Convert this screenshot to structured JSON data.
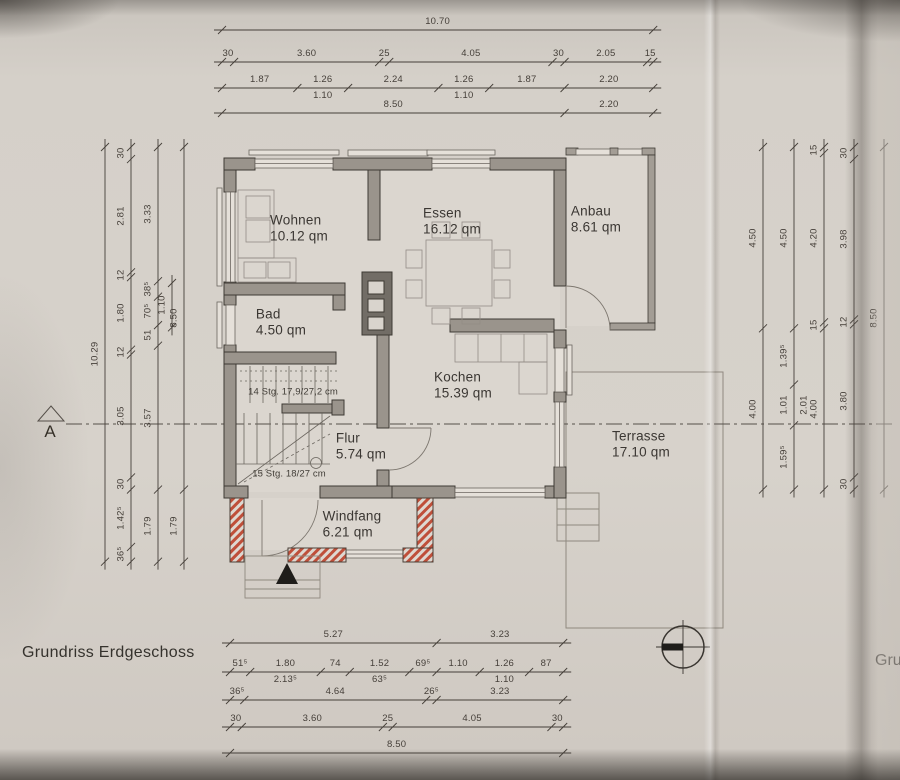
{
  "page": {
    "title": "Grundriss Erdgeschoss",
    "adjacent_page_text": "Gru"
  },
  "section": {
    "label": "A"
  },
  "rooms": {
    "wohnen": {
      "name": "Wohnen",
      "area": "10.12 qm"
    },
    "essen": {
      "name": "Essen",
      "area": "16.12 qm"
    },
    "anbau": {
      "name": "Anbau",
      "area": "8.61 qm"
    },
    "bad": {
      "name": "Bad",
      "area": "4.50 qm"
    },
    "kochen": {
      "name": "Kochen",
      "area": "15.39 qm"
    },
    "flur": {
      "name": "Flur",
      "area": "5.74 qm"
    },
    "windfang": {
      "name": "Windfang",
      "area": "6.21 qm"
    },
    "terrasse": {
      "name": "Terrasse",
      "area": "17.10 qm"
    }
  },
  "stairs": {
    "upper_label": "14 Stg. 17,9/27,2 cm",
    "lower_label": "15 Stg. 18/27 cm"
  },
  "colors": {
    "paper": "#d6d1ca",
    "wall_fill": "#9a948c",
    "wall_stroke": "#3e3a34",
    "thin_line": "#8b857d",
    "dimension": "#453f39",
    "new_wall_hatch": "#bf4f3a",
    "black": "#1f1d1a"
  },
  "dimensions": {
    "scale_px_per_m": 40.3,
    "chains": [
      {
        "id": "top-overall",
        "axis": "h",
        "line": 30,
        "start": 222,
        "scale": 40.3,
        "segments": [
          {
            "label": "10.70",
            "m": 10.7
          }
        ]
      },
      {
        "id": "top-outer",
        "axis": "h",
        "line": 62,
        "start": 222,
        "scale": 40.3,
        "segments": [
          {
            "label": "30",
            "m": 0.3
          },
          {
            "label": "3.60",
            "m": 3.6
          },
          {
            "label": "25",
            "m": 0.25
          },
          {
            "label": "4.05",
            "m": 4.05
          },
          {
            "label": "30",
            "m": 0.3
          },
          {
            "label": "2.05",
            "m": 2.05
          },
          {
            "label": "15",
            "m": 0.15
          }
        ]
      },
      {
        "id": "top-openings",
        "axis": "h",
        "line": 88,
        "start": 222,
        "scale": 40.3,
        "segments": [
          {
            "label": "1.87",
            "m": 1.87
          },
          {
            "label": "1.26",
            "m": 1.26,
            "sub": "1.10"
          },
          {
            "label": "2.24",
            "m": 2.24
          },
          {
            "label": "1.26",
            "m": 1.26,
            "sub": "1.10"
          },
          {
            "label": "1.87",
            "m": 1.87
          },
          {
            "label": "2.20",
            "m": 2.2
          }
        ]
      },
      {
        "id": "top-inner",
        "axis": "h",
        "line": 113,
        "start": 222,
        "scale": 40.3,
        "segments": [
          {
            "label": "8.50",
            "m": 8.5
          },
          {
            "label": "2.20",
            "m": 2.2
          }
        ]
      },
      {
        "id": "bottom-upper",
        "axis": "h",
        "line": 643,
        "start": 230,
        "scale": 39.2,
        "segments": [
          {
            "label": "5.27",
            "m": 5.27
          },
          {
            "label": "3.23",
            "m": 3.23
          }
        ]
      },
      {
        "id": "bottom-openings",
        "axis": "h",
        "line": 672,
        "start": 230,
        "scale": 39.2,
        "segments": [
          {
            "label": "51⁵",
            "m": 0.515
          },
          {
            "label": "1.80",
            "m": 1.8,
            "sub": "2.13⁵"
          },
          {
            "label": "74",
            "m": 0.74
          },
          {
            "label": "1.52",
            "m": 1.52,
            "sub": "63⁵"
          },
          {
            "label": "69⁵",
            "m": 0.695
          },
          {
            "label": "1.10",
            "m": 1.1
          },
          {
            "label": "1.26",
            "m": 1.26,
            "sub": "1.10"
          },
          {
            "label": "87",
            "m": 0.87
          }
        ]
      },
      {
        "id": "bottom-mid",
        "axis": "h",
        "line": 700,
        "start": 230,
        "scale": 39.2,
        "segments": [
          {
            "label": "36⁵",
            "m": 0.365
          },
          {
            "label": "4.64",
            "m": 4.64
          },
          {
            "label": "26⁵",
            "m": 0.265
          },
          {
            "label": "3.23",
            "m": 3.23
          }
        ]
      },
      {
        "id": "bottom-outer",
        "axis": "h",
        "line": 727,
        "start": 230,
        "scale": 39.2,
        "segments": [
          {
            "label": "30",
            "m": 0.3
          },
          {
            "label": "3.60",
            "m": 3.6
          },
          {
            "label": "25",
            "m": 0.25
          },
          {
            "label": "4.05",
            "m": 4.05
          },
          {
            "label": "30",
            "m": 0.3
          }
        ]
      },
      {
        "id": "bottom-overall",
        "axis": "h",
        "line": 753,
        "start": 230,
        "scale": 39.2,
        "segments": [
          {
            "label": "8.50",
            "m": 8.5
          }
        ]
      },
      {
        "id": "left-overall",
        "axis": "v",
        "line": 105,
        "start": 147,
        "scale": 40.3,
        "segments": [
          {
            "label": "10.29",
            "m": 10.29
          }
        ]
      },
      {
        "id": "left-rooms",
        "axis": "v",
        "line": 131,
        "start": 147,
        "scale": 40.3,
        "segments": [
          {
            "label": "30",
            "m": 0.3
          },
          {
            "label": "2.81",
            "m": 2.81
          },
          {
            "label": "12",
            "m": 0.12
          },
          {
            "label": "1.80",
            "m": 1.8
          },
          {
            "label": "12",
            "m": 0.12
          },
          {
            "label": "3.05",
            "m": 3.05
          },
          {
            "label": "30",
            "m": 0.3
          },
          {
            "label": "1.42⁵",
            "m": 1.425
          },
          {
            "label": "36⁵",
            "m": 0.365
          }
        ]
      },
      {
        "id": "left-inner",
        "axis": "v",
        "line": 158,
        "start": 147,
        "scale": 40.3,
        "segments": [
          {
            "label": "3.33",
            "m": 3.33
          },
          {
            "label": "38⁵",
            "m": 0.385
          },
          {
            "label": "70⁵",
            "m": 0.705
          },
          {
            "label": "51",
            "m": 0.51
          },
          {
            "label": "3.57",
            "m": 3.57
          },
          {
            "label": "1.79",
            "m": 1.79
          }
        ]
      },
      {
        "id": "left-bad-window",
        "axis": "v",
        "line": 172,
        "start": 283,
        "scale": 40.3,
        "segments": [
          {
            "label": "1.10",
            "m": 1.1
          }
        ]
      },
      {
        "id": "left-shell",
        "axis": "v",
        "line": 184,
        "start": 147,
        "scale": 40.3,
        "segments": [
          {
            "label": "8.50",
            "m": 8.5
          },
          {
            "label": "1.79",
            "m": 1.79
          }
        ]
      },
      {
        "id": "right-rooms",
        "axis": "v",
        "line": 763,
        "start": 147,
        "scale": 40.3,
        "segments": [
          {
            "label": "4.50",
            "m": 4.5
          },
          {
            "label": "4.00",
            "m": 4.0
          }
        ]
      },
      {
        "id": "right-openings",
        "axis": "v",
        "line": 794,
        "start": 147,
        "scale": 40.3,
        "segments": [
          {
            "label": "4.50",
            "m": 4.5
          },
          {
            "label": "1.39⁵",
            "m": 1.395
          },
          {
            "label": "1.01",
            "m": 1.01,
            "sub": "2.01"
          },
          {
            "label": "1.59⁵",
            "m": 1.595
          }
        ]
      },
      {
        "id": "right-inner",
        "axis": "v",
        "line": 824,
        "start": 147,
        "scale": 40.3,
        "segments": [
          {
            "label": "15",
            "m": 0.15
          },
          {
            "label": "4.20",
            "m": 4.2
          },
          {
            "label": "15",
            "m": 0.15
          },
          {
            "label": "4.00",
            "m": 4.0
          }
        ]
      },
      {
        "id": "right-outer",
        "axis": "v",
        "line": 854,
        "start": 147,
        "scale": 40.3,
        "segments": [
          {
            "label": "30",
            "m": 0.3
          },
          {
            "label": "3.98",
            "m": 3.98
          },
          {
            "label": "12",
            "m": 0.12
          },
          {
            "label": "3.80",
            "m": 3.8
          },
          {
            "label": "30",
            "m": 0.3
          }
        ]
      },
      {
        "id": "right-overall",
        "axis": "v",
        "line": 884,
        "start": 147,
        "scale": 40.3,
        "segments": [
          {
            "label": "8.50",
            "m": 8.5
          }
        ]
      }
    ]
  }
}
